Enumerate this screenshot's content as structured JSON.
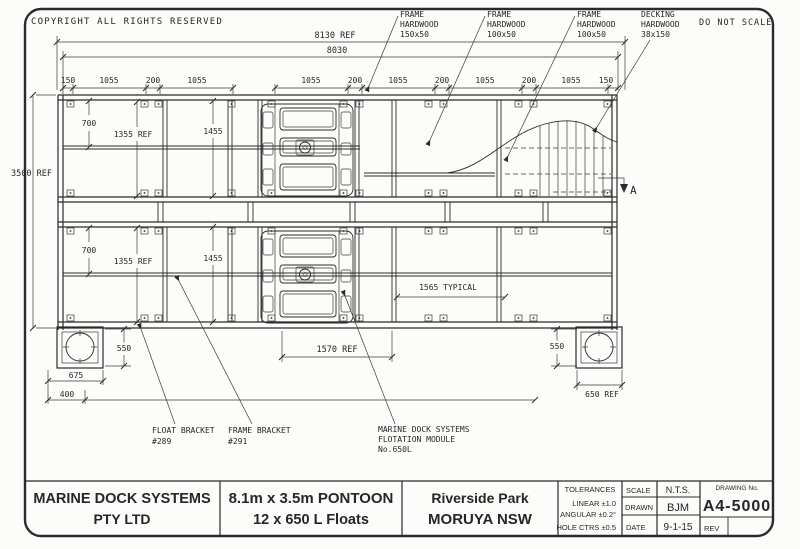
{
  "header": {
    "copyright": "COPYRIGHT  ALL  RIGHTS  RESERVED",
    "do_not_scale": "DO  NOT  SCALE"
  },
  "callouts": {
    "frame1": [
      "FRAME",
      "HARDWOOD",
      "150x50"
    ],
    "frame2": [
      "FRAME",
      "HARDWOOD",
      "100x50"
    ],
    "frame3": [
      "FRAME",
      "HARDWOOD",
      "100x50"
    ],
    "decking": [
      "DECKING",
      "HARDWOOD",
      "38x150"
    ],
    "float_bracket": [
      "FLOAT  BRACKET",
      "#289"
    ],
    "frame_bracket": [
      "FRAME  BRACKET",
      "#291"
    ],
    "flotation": [
      "MARINE  DOCK  SYSTEMS",
      "FLOTATION  MODULE",
      "No.650L"
    ]
  },
  "dimensions": {
    "overall_ref": "8130  REF",
    "overall": "8030",
    "chain_left": [
      "150",
      "1055",
      "200",
      "1055"
    ],
    "chain_right": [
      "1055",
      "200",
      "1055",
      "200",
      "1055",
      "200",
      "1055",
      "150"
    ],
    "height_ref": "3500 REF",
    "d700": "700",
    "d1355": "1355  REF",
    "d1455": "1455",
    "typical": "1565  TYPICAL",
    "d1570": "1570  REF",
    "d550": "550",
    "d675": "675",
    "d400": "400",
    "d650": "650  REF"
  },
  "section_marker": "A",
  "title_block": {
    "company": [
      "MARINE  DOCK  SYSTEMS",
      "PTY  LTD"
    ],
    "title": [
      "8.1m x 3.5m PONTOON",
      "12 x 650 L Floats"
    ],
    "location": [
      "Riverside Park",
      "MORUYA NSW"
    ],
    "tolerances": {
      "header": "TOLERANCES",
      "rows": [
        "LINEAR  ±1.0",
        "ANGULAR  ±0.2°",
        "HOLE  CTRS  ±0.5"
      ]
    },
    "scale_label": "SCALE",
    "scale": "N.T.S.",
    "drawn_label": "DRAWN",
    "drawn": "BJM",
    "date_label": "DATE",
    "date": "9-1-15",
    "drawing_no_label": "DRAWING  No.",
    "drawing_no": "A4-5000",
    "rev_label": "REV"
  }
}
